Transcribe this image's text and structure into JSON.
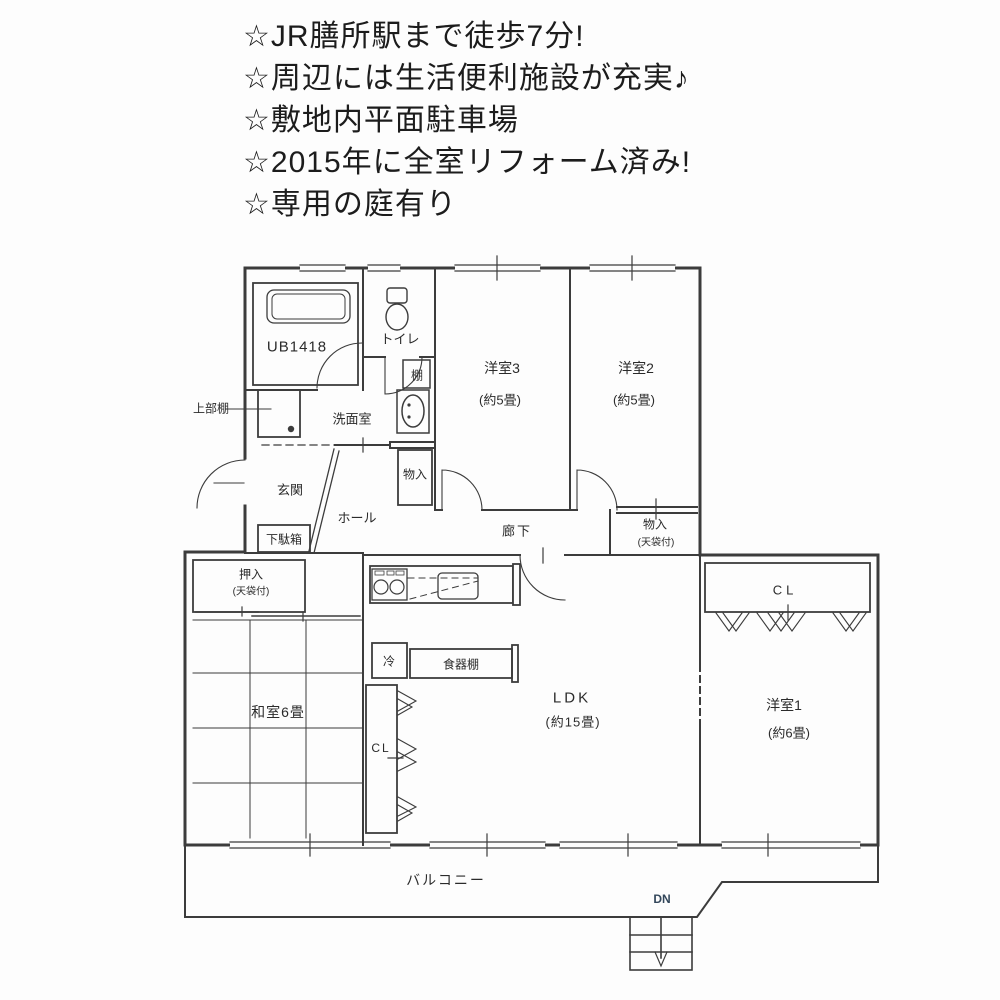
{
  "header": {
    "lines": [
      "☆JR膳所駅まで徒歩7分!",
      "☆周辺には生活便利施設が充実♪",
      "☆敷地内平面駐車場",
      "☆2015年に全室リフォーム済み!",
      "☆専用の庭有り"
    ]
  },
  "plan": {
    "labels": {
      "ub": "UB1418",
      "toilet": "トイレ",
      "shelf": "棚",
      "upper_shelf": "上部棚",
      "washroom": "洗面室",
      "hall_storage": "物入",
      "entrance": "玄関",
      "hall": "ホール",
      "shoe_box": "下駄箱",
      "corridor": "廊下",
      "storage2_name": "物入",
      "storage2_size": "(天袋付)",
      "oshiire_name": "押入",
      "oshiire_size": "(天袋付)",
      "washitsu": "和室6畳",
      "fridge": "冷",
      "cupboard": "食器棚",
      "ldk_name": "LDK",
      "ldk_size": "(約15畳)",
      "cl_left": "CL",
      "cl_right": "CL",
      "west1_name": "洋室1",
      "west1_size": "(約6畳)",
      "west2_name": "洋室2",
      "west2_size": "(約5畳)",
      "west3_name": "洋室3",
      "west3_size": "(約5畳)",
      "balcony": "バルコニー",
      "down": "DN"
    },
    "colors": {
      "line": "#3c3c3c",
      "dn_text": "#33475b",
      "background": "#fdfdfd",
      "text": "#2b2b2b"
    }
  }
}
